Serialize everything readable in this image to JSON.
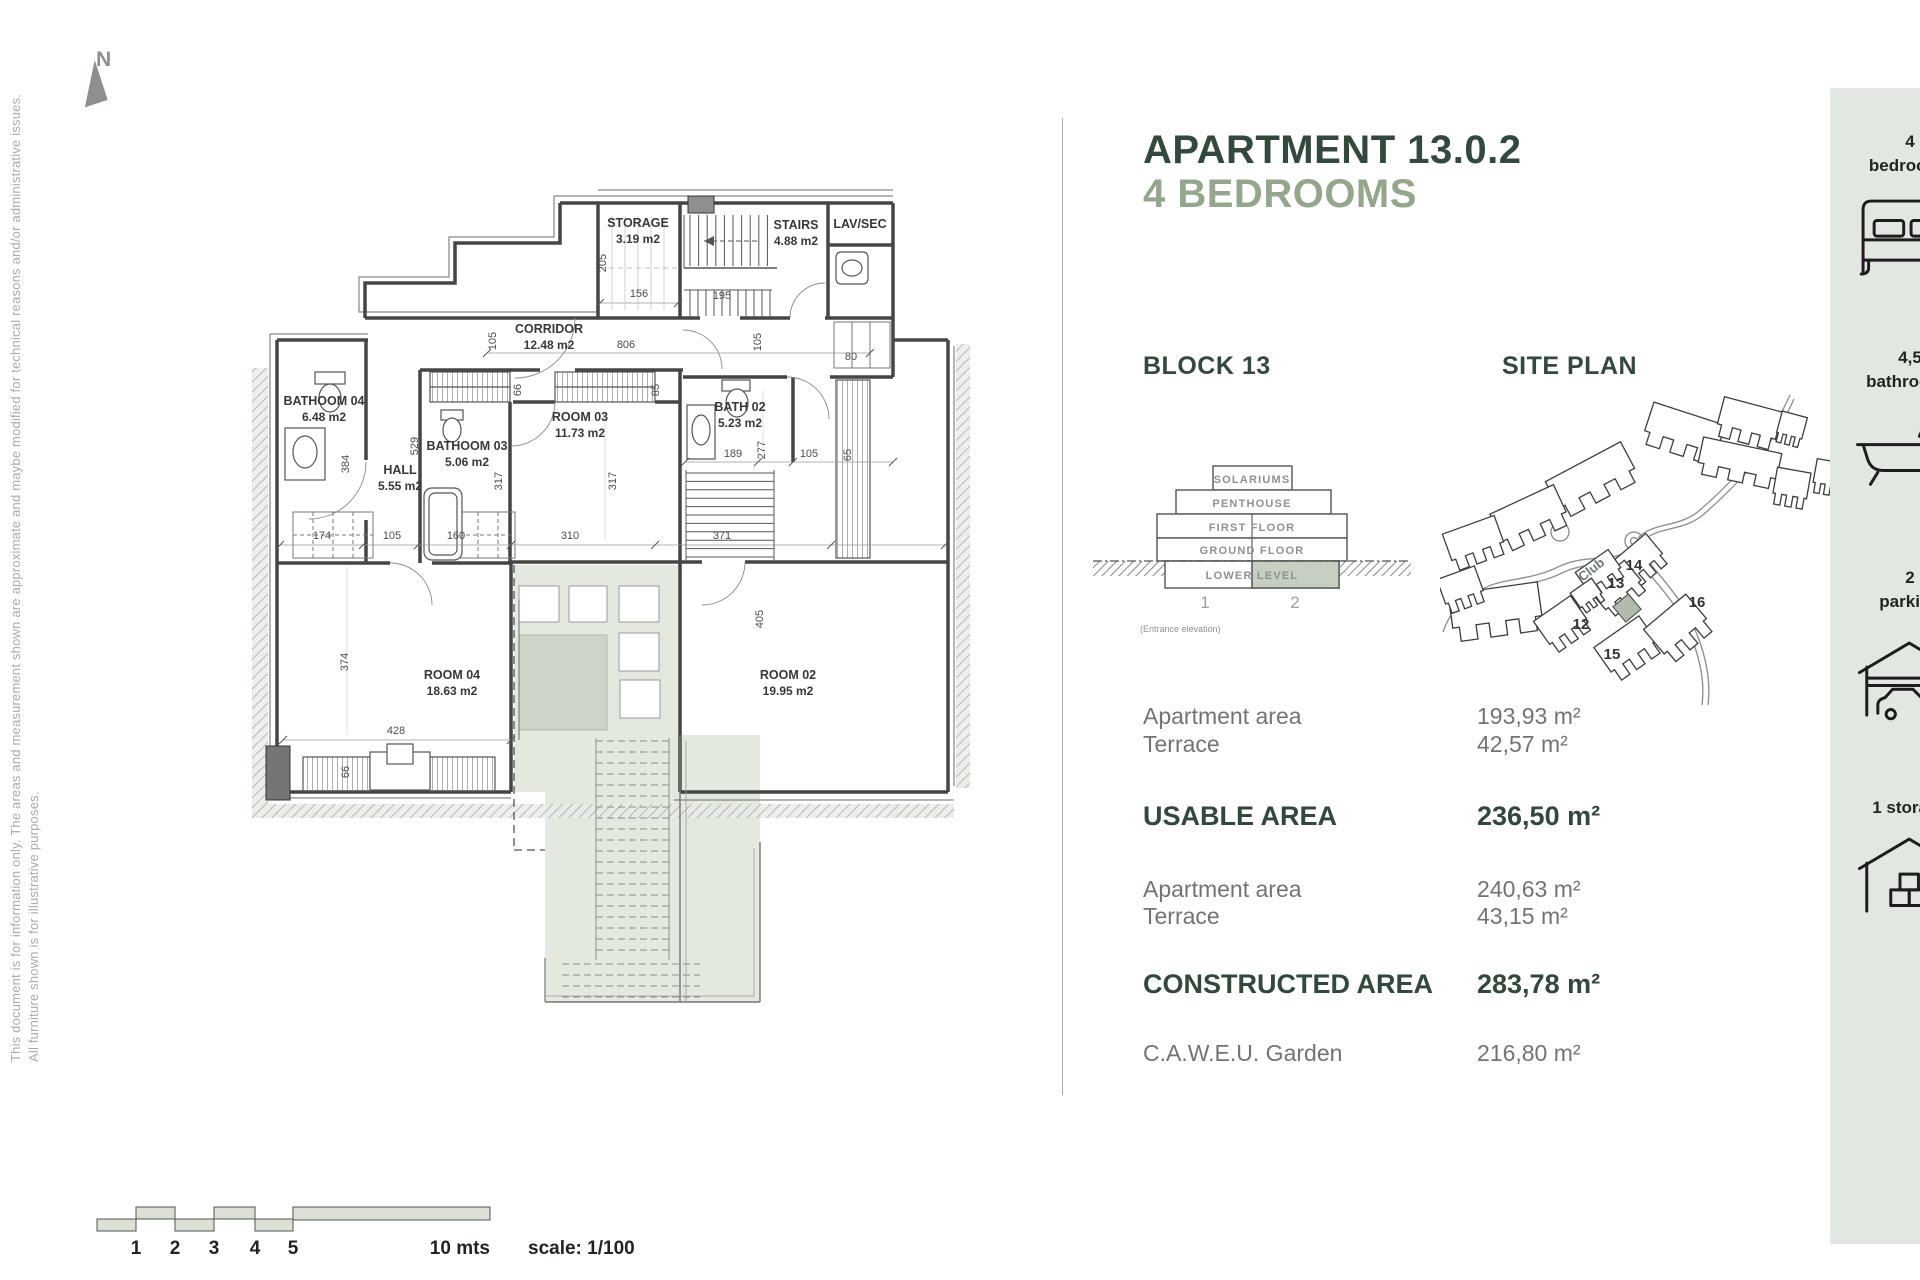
{
  "header": {
    "title_line1": "APARTMENT 13.0.2",
    "title_line2": "4 BEDROOMS",
    "accent_color": "#33493c",
    "sub_color": "#94a78c"
  },
  "notes": {
    "line1": "This document is for information only. The areas and measurement shown are approximate and maybe modified for technical reasons and/or administrative issues.",
    "line2": "All furniture shown is for illustrative purposes.",
    "north_label": "N"
  },
  "block": {
    "title": "BLOCK 13",
    "floors": [
      "SOLARIUMS",
      "PENTHOUSE",
      "FIRST FLOOR",
      "GROUND FLOOR",
      "LOWER LEVEL"
    ],
    "units": [
      "1",
      "2"
    ],
    "caption": "(Entrance elevation)",
    "highlight_color": "#c7cfc3"
  },
  "site": {
    "title": "SITE PLAN",
    "labels": [
      {
        "t": "14",
        "x": 194,
        "y": 190
      },
      {
        "t": "13",
        "x": 176,
        "y": 208
      },
      {
        "t": "16",
        "x": 257,
        "y": 227
      },
      {
        "t": "12",
        "x": 141,
        "y": 249
      },
      {
        "t": "15",
        "x": 172,
        "y": 279
      },
      {
        "t": "Club",
        "x": 154,
        "y": 193,
        "r": -38,
        "cls": "club"
      }
    ]
  },
  "areas": {
    "rows": [
      {
        "label": "Apartment area",
        "value": "193,93 m²",
        "bold": false
      },
      {
        "label": "Terrace",
        "value": "42,57 m²",
        "bold": false
      },
      {
        "label": "USABLE AREA",
        "value": "236,50 m²",
        "bold": true
      },
      {
        "label": "Apartment area",
        "value": "240,63 m²",
        "bold": false
      },
      {
        "label": "Terrace",
        "value": "43,15 m²",
        "bold": false
      },
      {
        "label": "CONSTRUCTED AREA",
        "value": "283,78 m²",
        "bold": true
      },
      {
        "label": "C.A.W.E.U. Garden",
        "value": "216,80 m²",
        "bold": false
      }
    ]
  },
  "sidebar": {
    "items": [
      {
        "line1": "4",
        "line2": "bedrooms",
        "icon": "bed-icon"
      },
      {
        "line1": "4,5",
        "line2": "bathrooms",
        "icon": "bathtub-icon"
      },
      {
        "line1": "2",
        "line2": "parking",
        "icon": "garage-car-icon"
      },
      {
        "line1": "1 storage",
        "line2": "",
        "icon": "storage-box-icon"
      }
    ]
  },
  "floorplan": {
    "rooms": [
      {
        "name": "STORAGE",
        "area": "3.19 m2",
        "x": 638,
        "y": 227
      },
      {
        "name": "STAIRS",
        "area": "4.88 m2",
        "x": 796,
        "y": 229
      },
      {
        "name": "LAV/SEC",
        "area": "",
        "x": 860,
        "y": 228,
        "small": true
      },
      {
        "name": "CORRIDOR",
        "area": "12.48 m2",
        "x": 549,
        "y": 333
      },
      {
        "name": "BATHOOM 04",
        "area": "6.48 m2",
        "x": 324,
        "y": 405
      },
      {
        "name": "HALL",
        "area": "5.55 m2",
        "x": 400,
        "y": 474
      },
      {
        "name": "BATHOOM 03",
        "area": "5.06 m2",
        "x": 467,
        "y": 450
      },
      {
        "name": "ROOM 03",
        "area": "11.73 m2",
        "x": 580,
        "y": 421
      },
      {
        "name": "BATH 02",
        "area": "5.23 m2",
        "x": 740,
        "y": 411
      },
      {
        "name": "ROOM 04",
        "area": "18.63 m2",
        "x": 452,
        "y": 679
      },
      {
        "name": "ROOM 02",
        "area": "19.95 m2",
        "x": 788,
        "y": 679
      }
    ],
    "dims": [
      {
        "t": "205",
        "x": 606,
        "y": 263,
        "r": -90
      },
      {
        "t": "156",
        "x": 639,
        "y": 297
      },
      {
        "t": "195",
        "x": 722,
        "y": 299
      },
      {
        "t": "806",
        "x": 626,
        "y": 348
      },
      {
        "t": "105",
        "x": 496,
        "y": 341,
        "r": -90
      },
      {
        "t": "105",
        "x": 761,
        "y": 342,
        "r": -90
      },
      {
        "t": "80",
        "x": 851,
        "y": 360
      },
      {
        "t": "66",
        "x": 521,
        "y": 390,
        "r": -90
      },
      {
        "t": "85",
        "x": 659,
        "y": 390,
        "r": -90
      },
      {
        "t": "384",
        "x": 349,
        "y": 464,
        "r": -90
      },
      {
        "t": "529",
        "x": 418,
        "y": 446,
        "r": -90
      },
      {
        "t": "317",
        "x": 502,
        "y": 481,
        "r": -90
      },
      {
        "t": "317",
        "x": 616,
        "y": 481,
        "r": -90
      },
      {
        "t": "174",
        "x": 322,
        "y": 539
      },
      {
        "t": "105",
        "x": 392,
        "y": 539
      },
      {
        "t": "160",
        "x": 456,
        "y": 539
      },
      {
        "t": "310",
        "x": 570,
        "y": 539
      },
      {
        "t": "371",
        "x": 722,
        "y": 539
      },
      {
        "t": "189",
        "x": 733,
        "y": 457
      },
      {
        "t": "277",
        "x": 765,
        "y": 450,
        "r": -90
      },
      {
        "t": "105",
        "x": 809,
        "y": 457
      },
      {
        "t": "65",
        "x": 851,
        "y": 455,
        "r": -90
      },
      {
        "t": "374",
        "x": 348,
        "y": 662,
        "r": -90
      },
      {
        "t": "428",
        "x": 396,
        "y": 734
      },
      {
        "t": "405",
        "x": 763,
        "y": 619,
        "r": -90
      },
      {
        "t": "66",
        "x": 349,
        "y": 772,
        "r": -90
      }
    ]
  },
  "scalebar": {
    "ticks": [
      {
        "t": "1",
        "x": 136
      },
      {
        "t": "2",
        "x": 175
      },
      {
        "t": "3",
        "x": 214
      },
      {
        "t": "4",
        "x": 255
      },
      {
        "t": "5",
        "x": 293
      }
    ],
    "end_label": "10 mts",
    "scale_label": "scale: 1/100"
  }
}
